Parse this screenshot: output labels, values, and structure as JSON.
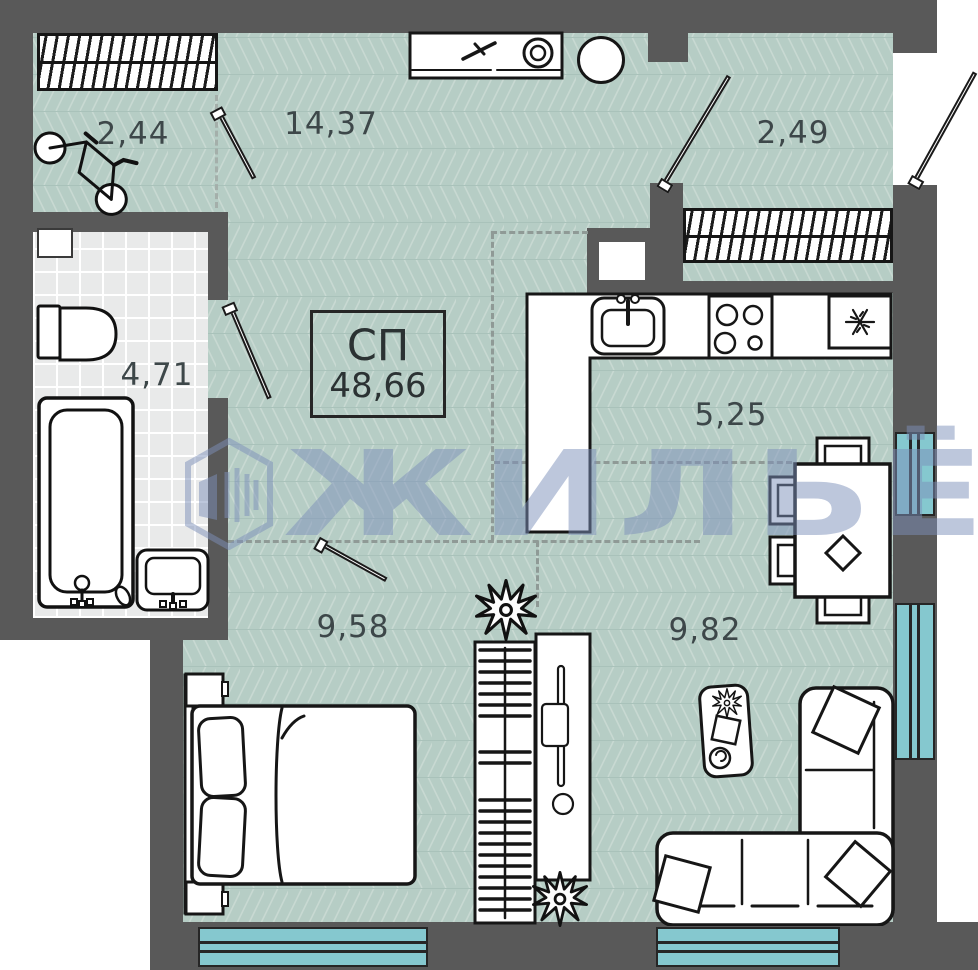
{
  "plan": {
    "type_label": "СП",
    "total_area": "48,66"
  },
  "rooms": {
    "loggia_left": "2,44",
    "hall": "14,37",
    "loggia_right": "2,49",
    "bathroom": "4,71",
    "kitchen": "5,25",
    "bedroom": "9,58",
    "living": "9,82"
  },
  "watermark": {
    "text": "ЖИЛЬЁ",
    "logo": "buildings-hex-logo"
  },
  "colors": {
    "wall": "#595959",
    "floor": "#b6cdc5",
    "floor_stripe": "#c8d9d2",
    "tile": "#e9eaea",
    "window": "#85c8cf",
    "outline": "#1a1a1a",
    "label": "#3d4749",
    "watermark": "#7d90ba",
    "dash": "#8f9a96"
  },
  "fixtures": [
    "radiator",
    "bicycle",
    "washing-machine",
    "water-heater",
    "toilet",
    "bathtub",
    "washbasin",
    "kitchen-sink",
    "stove",
    "fridge",
    "dining-table",
    "chair",
    "bed",
    "nightstand",
    "wardrobe",
    "plant",
    "sofa",
    "coffee-table",
    "window",
    "door"
  ]
}
